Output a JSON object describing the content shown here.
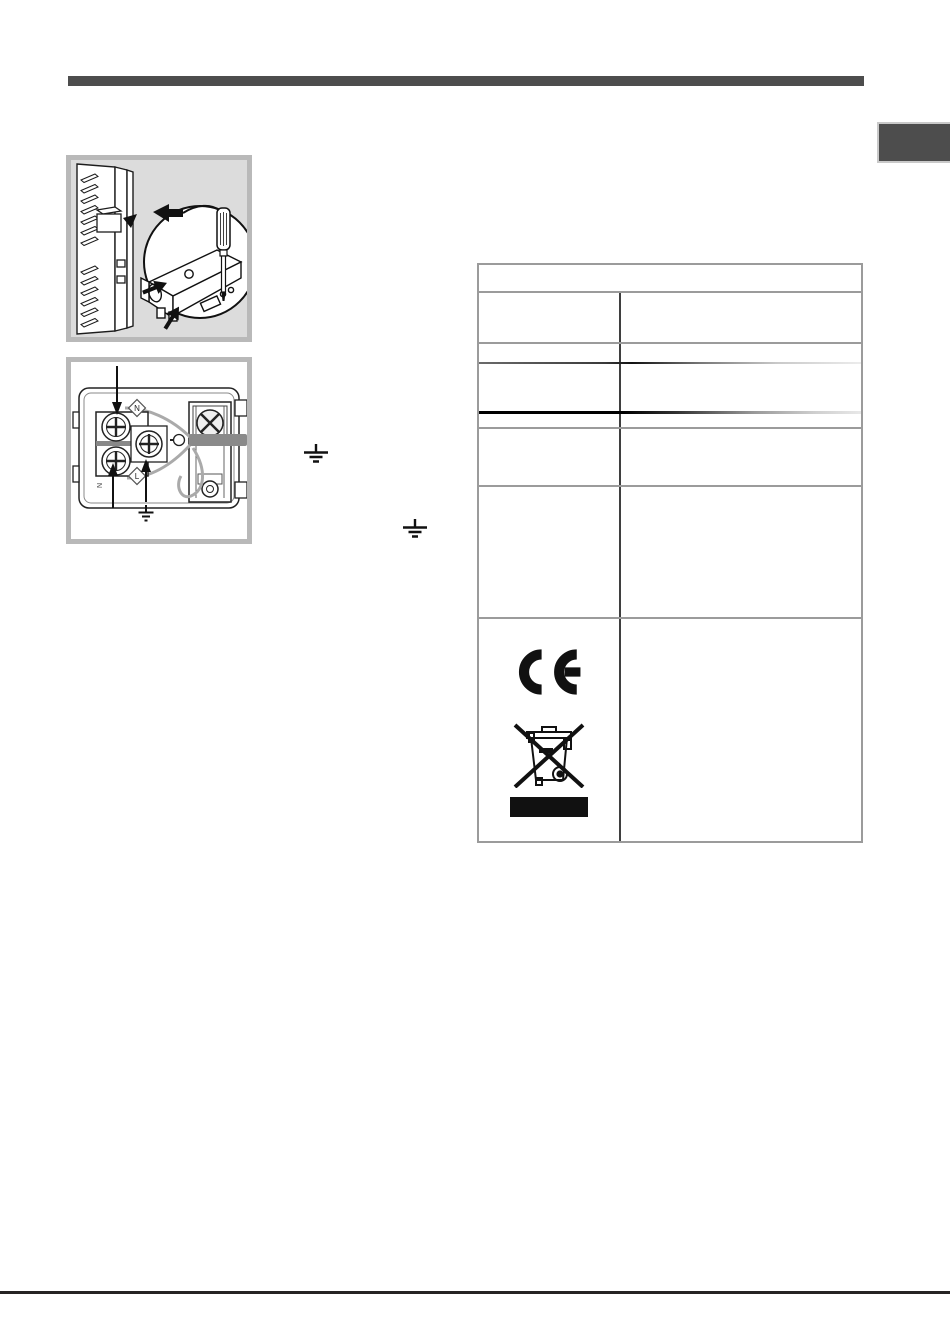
{
  "chrome": {
    "top_bar_color": "#4d4d4d",
    "side_tab_color": "#4d4d4d",
    "bottom_rule_color": "#262323"
  },
  "figures": {
    "terminal_cover": {
      "name": "terminal-cover-removal"
    },
    "terminal_board": {
      "name": "terminal-board-wiring",
      "labels": {
        "diamond_top": "N",
        "diamond_bottom": "L",
        "side_n": "N"
      }
    }
  },
  "inline_symbols": {
    "earth_1": "earth-ground",
    "earth_2": "earth-ground"
  },
  "table": {
    "header_text": "",
    "rows": [
      {
        "left": "",
        "right": ""
      },
      {
        "left": "",
        "right": ""
      },
      {
        "left": "",
        "right": ""
      },
      {
        "left": "",
        "right": ""
      },
      {
        "left": "",
        "right": ""
      },
      {
        "left": "",
        "right": ""
      }
    ],
    "symbol_row": {
      "symbols": [
        "ce-marking",
        "weee-crossed-out-wheelie-bin",
        "black-bar"
      ],
      "right": ""
    }
  },
  "colors": {
    "table_rule": "#9b9b9b",
    "table_divider": "#3f3f3f",
    "figure_frame": "#b9b9b9",
    "figure1_background": "#dcdcdc",
    "ink": "#1a1a1a",
    "cable_gray": "#8a8a8a"
  }
}
